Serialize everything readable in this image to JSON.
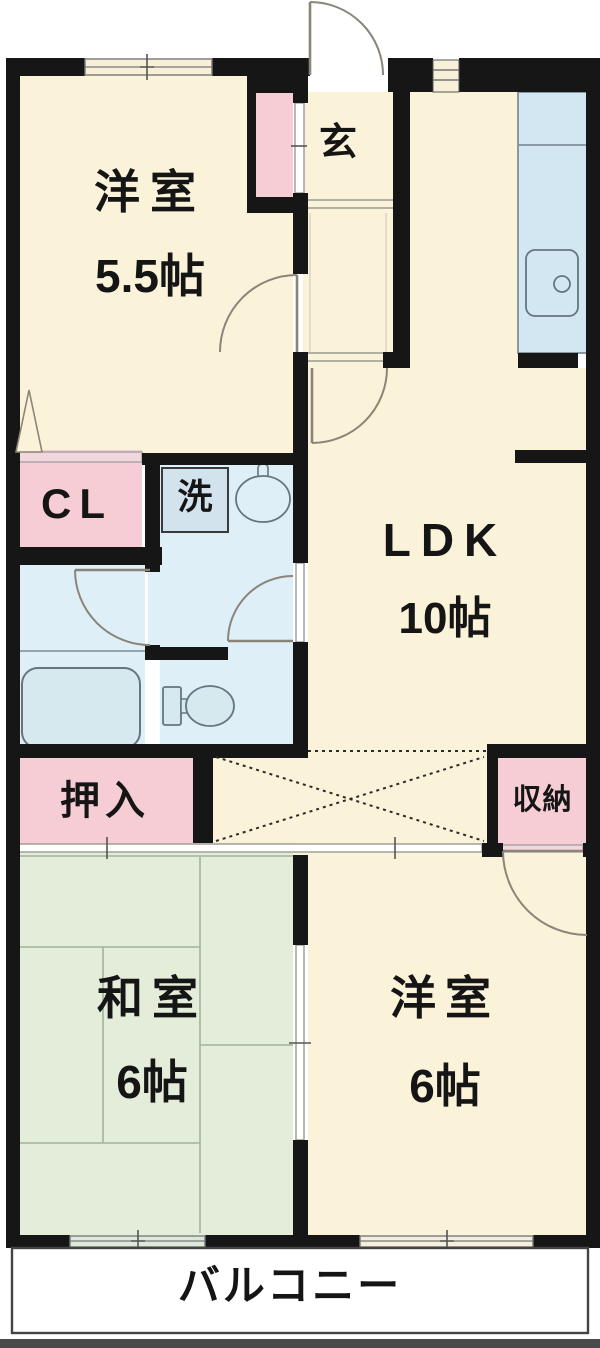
{
  "floorplan": {
    "title": "2LDK apartment floor plan",
    "rooms": {
      "western_room_5_5": {
        "name": "洋室",
        "size": "5.5帖"
      },
      "entrance": {
        "name": "玄"
      },
      "ldk": {
        "name": "LDK",
        "size": "10帖"
      },
      "closet": {
        "name": "CL"
      },
      "laundry": {
        "name": "洗"
      },
      "oshiire": {
        "name": "押入"
      },
      "storage": {
        "name": "収納"
      },
      "japanese_room": {
        "name": "和室",
        "size": "6帖"
      },
      "western_room_6": {
        "name": "洋室",
        "size": "6帖"
      },
      "balcony": {
        "name": "バルコニー"
      }
    },
    "colors": {
      "wall": "#161616",
      "room_cream": "#FBF2DA",
      "closet_pink": "#F6CCD5",
      "closet_front_pink": "#F2D6DE",
      "wet_area_blue": "#DEEFF8",
      "counter_blue": "#D2E7F2",
      "fixture_blue": "#D6E9EE",
      "tatami_green": "#E4EDDA",
      "window_green": "#DCE9D8",
      "door_line": "#8a8578",
      "balcony_white": "#FFFFFF"
    }
  }
}
